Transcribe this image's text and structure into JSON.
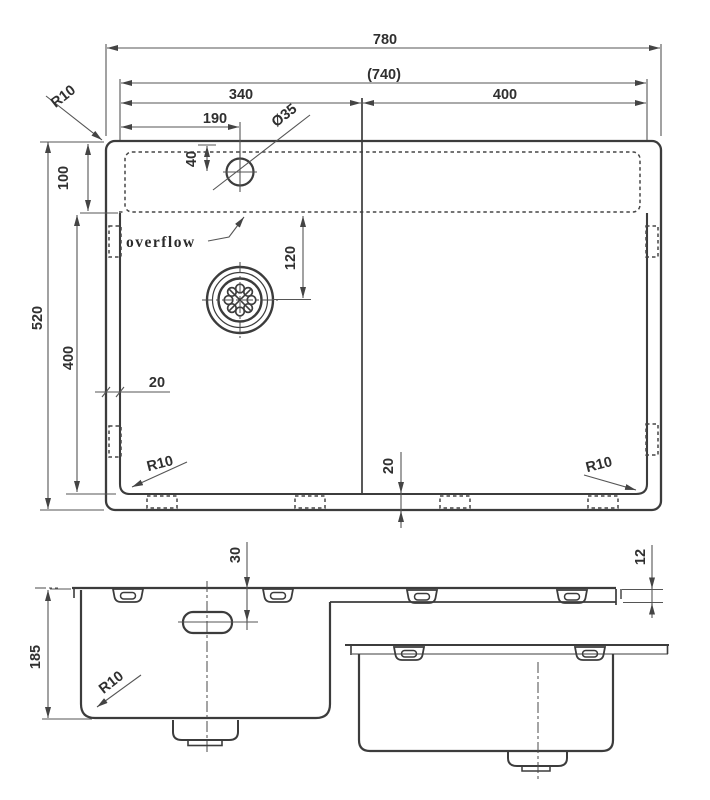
{
  "top_view": {
    "overall_width": "780",
    "inner_width": "(740)",
    "left_bowl_width": "340",
    "right_bowl_width": "400",
    "tap_hole_offset": "190",
    "tap_hole_diameter": "Ø35",
    "tap_hole_inset": "40",
    "rear_ledge_depth": "100",
    "overall_depth": "520",
    "bowl_front_depth": "400",
    "drain_offset": "120",
    "side_gap": "20",
    "bottom_gap": "20",
    "corner_radius": "R10",
    "overflow_label": "overflow"
  },
  "section_view": {
    "bowl_depth": "185",
    "overflow_drop": "30",
    "ledge_drop": "12",
    "corner_radius": "R10"
  }
}
